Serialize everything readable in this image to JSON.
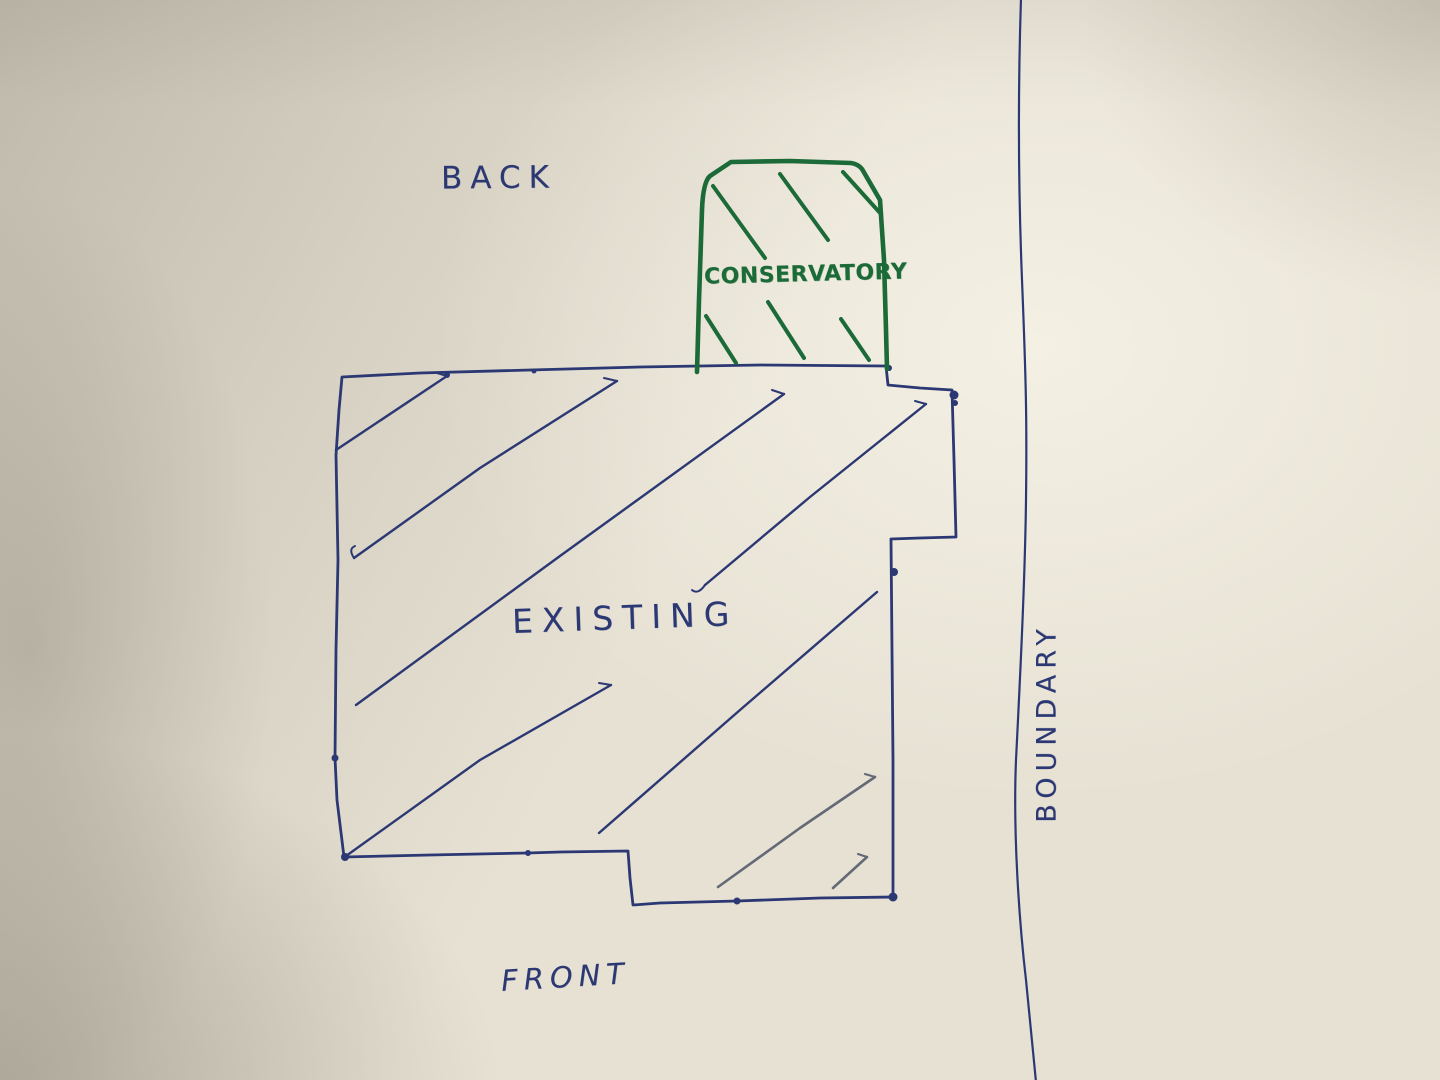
{
  "document": {
    "kind": "hand-drawn site plan sketch",
    "labels": {
      "back": "BACK",
      "conservatory": "CONSERVATORY",
      "existing": "EXISTING",
      "front": "FRONT",
      "boundary": "BOUNDARY"
    },
    "colors": {
      "ink_blue": "#2b3873",
      "ink_green": "#1b6a38",
      "pencil_grey": "#646976",
      "paper": "#e6e1d3"
    }
  }
}
